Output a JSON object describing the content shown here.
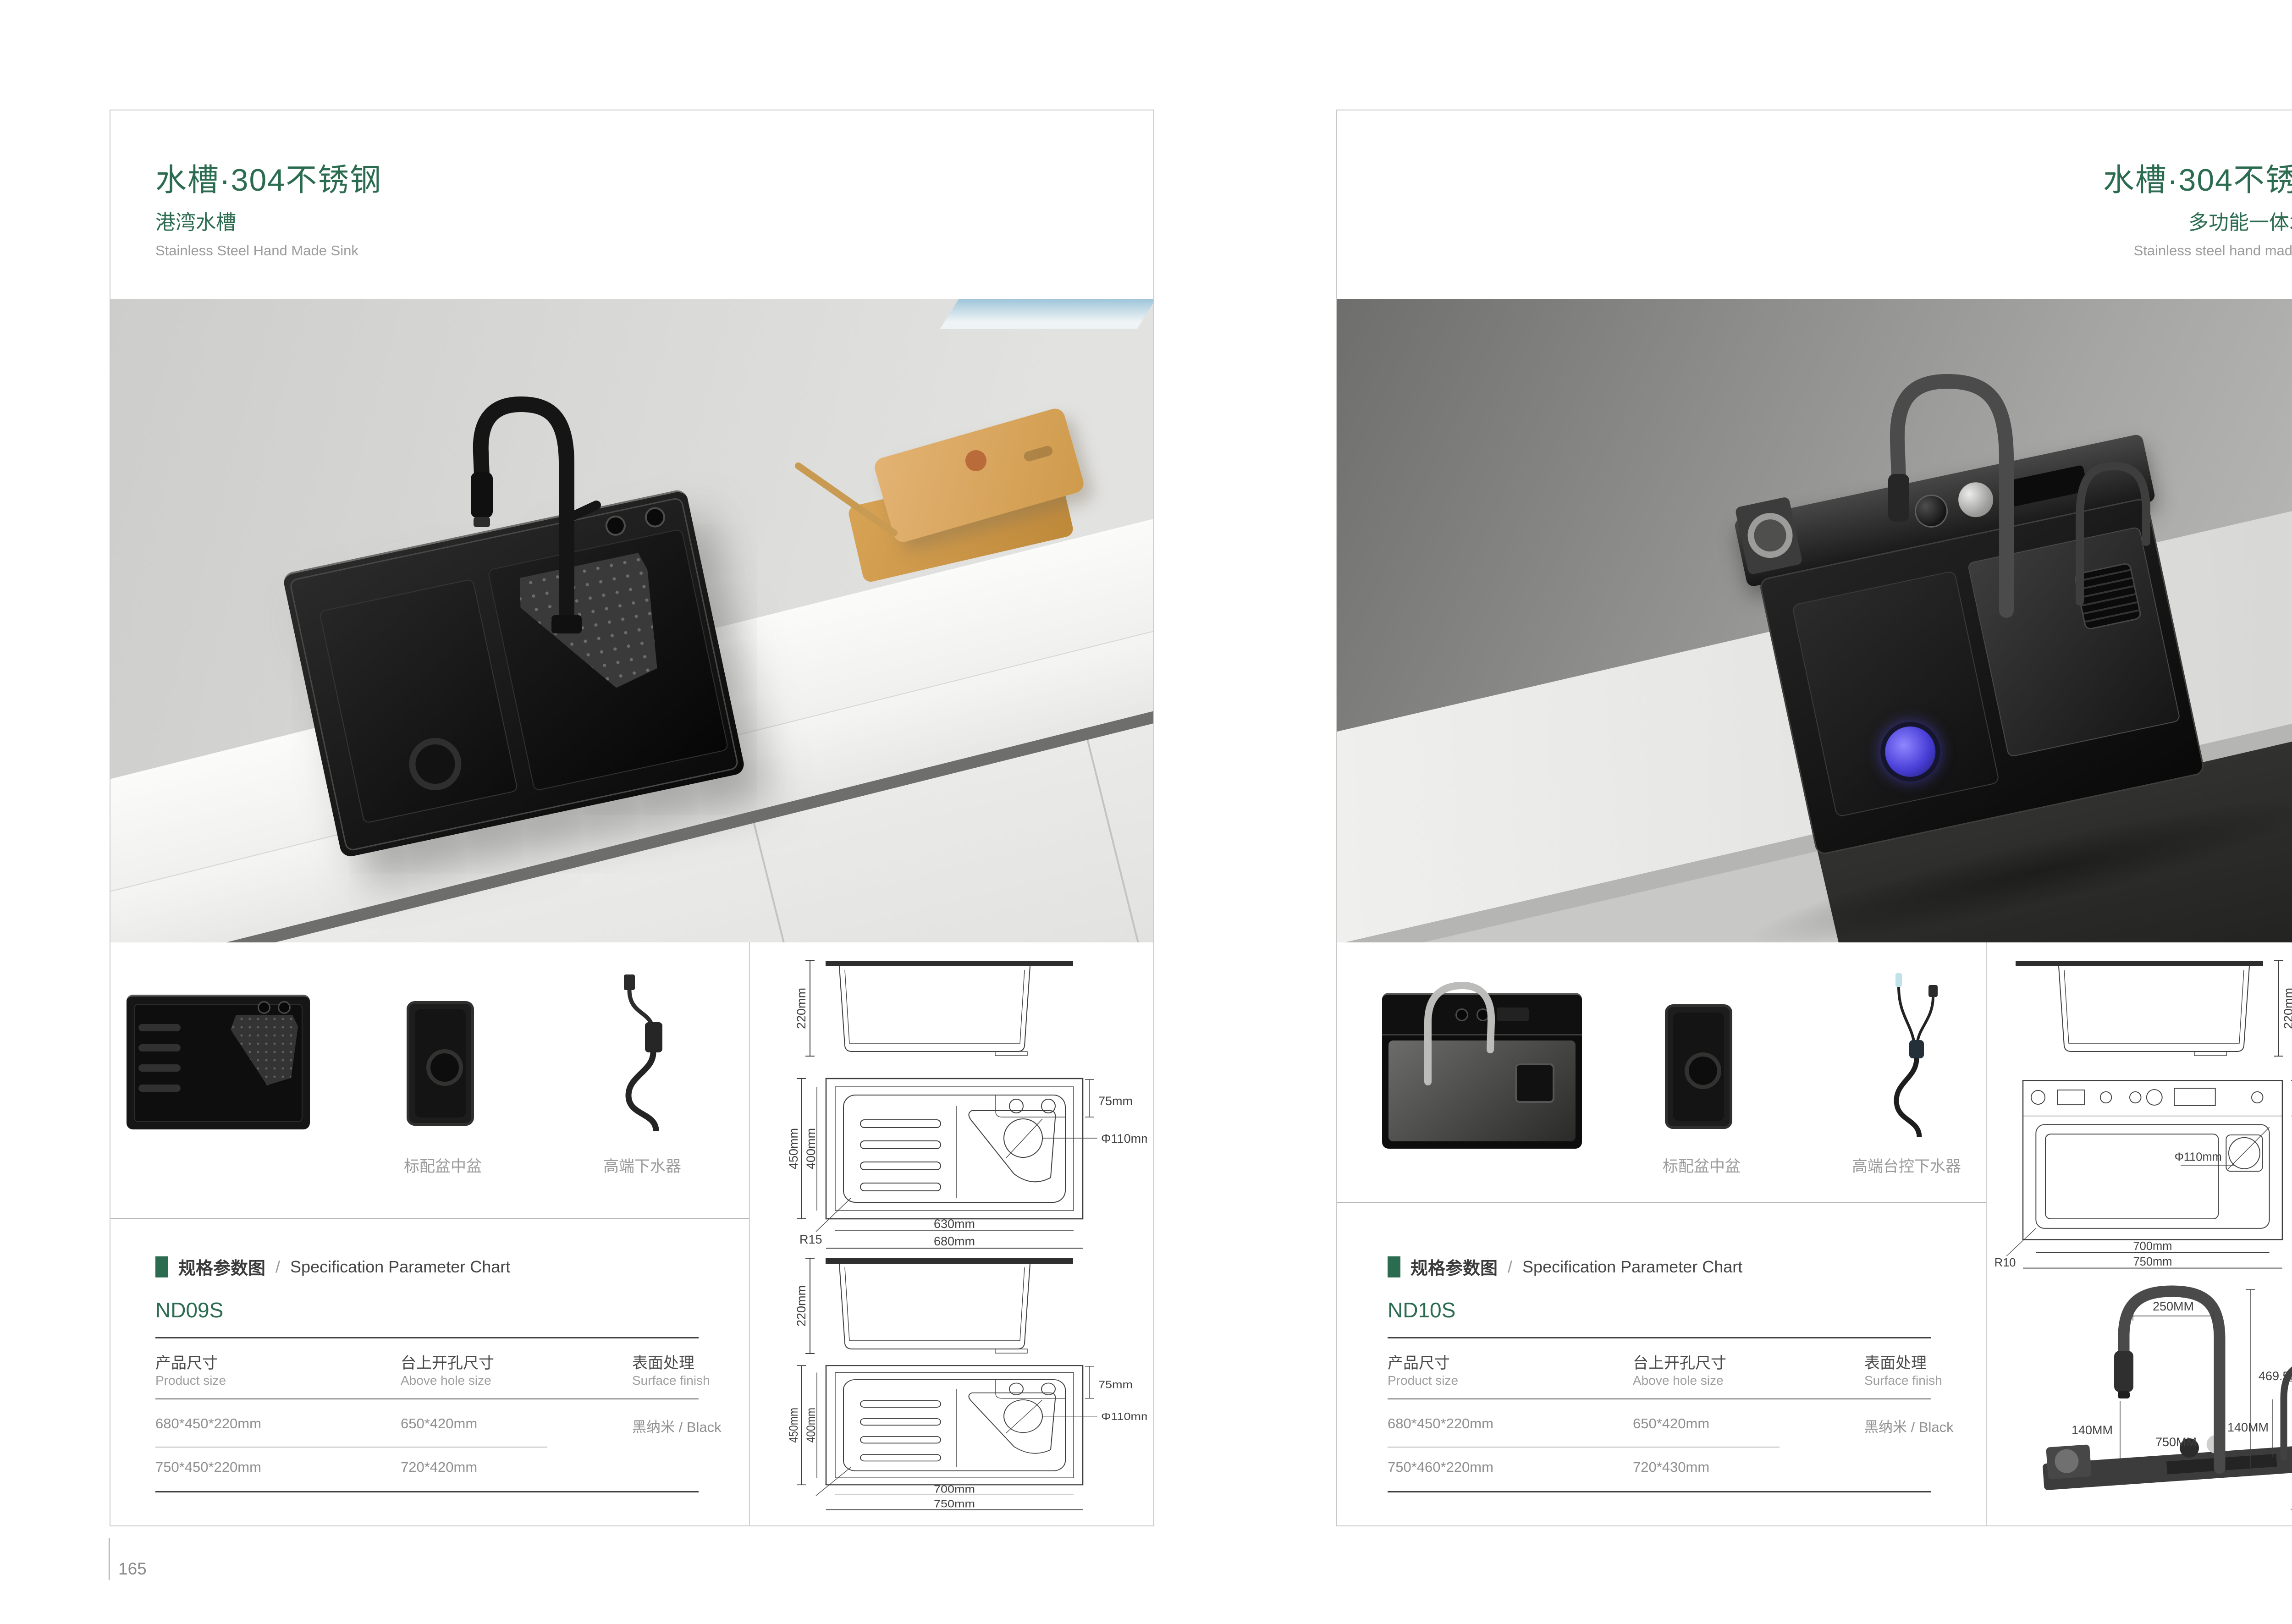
{
  "colors": {
    "accent_green": "#2b6b4f"
  },
  "left_page": {
    "page_number": "165",
    "title": "水槽·304不锈钢",
    "subtitle": "港湾水槽",
    "subtitle_en": "Stainless Steel Hand Made Sink",
    "thumb_label_mid": "标配盆中盆",
    "thumb_label_right": "高端下水器",
    "spec": {
      "section_cn": "规格参数图",
      "section_sep": "/",
      "section_en": "Specification Parameter Chart",
      "model": "ND09S",
      "col1_cn": "产品尺寸",
      "col1_en": "Product size",
      "col2_cn": "台上开孔尺寸",
      "col2_en": "Above hole size",
      "col3_cn": "表面处理",
      "col3_en": "Surface finish",
      "rows": [
        [
          "680*450*220mm",
          "650*420mm",
          "黑纳米 / Black"
        ],
        [
          "750*450*220mm",
          "720*420mm",
          ""
        ]
      ]
    },
    "drawings": {
      "side_height": "220mm",
      "plan1": {
        "outer_h": "450mm",
        "inner_h": "400mm",
        "ledge": "75mm",
        "dia": "Φ110mm",
        "radius": "R15",
        "inner_w": "630mm",
        "outer_w": "680mm"
      },
      "plan2": {
        "outer_h": "450mm",
        "inner_h": "400mm",
        "ledge": "75mm",
        "dia": "Φ110mm",
        "inner_w": "700mm",
        "outer_w": "750mm"
      }
    }
  },
  "right_page": {
    "page_number": "166",
    "title": "水槽·304不锈钢",
    "subtitle": "多功能一体水槽",
    "subtitle_en": "Stainless steel hand made sink",
    "thumb_label_mid": "标配盆中盆",
    "thumb_label_right": "高端台控下水器",
    "spec": {
      "section_cn": "规格参数图",
      "section_sep": "/",
      "section_en": "Specification Parameter Chart",
      "model": "ND10S",
      "col1_cn": "产品尺寸",
      "col1_en": "Product size",
      "col2_cn": "台上开孔尺寸",
      "col2_en": "Above hole size",
      "col3_cn": "表面处理",
      "col3_en": "Surface finish",
      "rows": [
        [
          "680*450*220mm",
          "650*420mm",
          "黑纳米 / Black"
        ],
        [
          "750*460*220mm",
          "720*430mm",
          ""
        ]
      ]
    },
    "drawings": {
      "side_height": "220mm",
      "plan": {
        "ledge": "80mm",
        "basin_h": "355mm",
        "outer_h": "460mm",
        "dia": "Φ110mm",
        "radius": "R10",
        "inner_w": "700mm",
        "outer_w": "750mm"
      },
      "faucet": {
        "spout_reach": "250MM",
        "total_height": "469.5MM",
        "spout_clearance": "140MM",
        "ledge_width": "750MM",
        "small_reach": "145MM",
        "small_clearance": "140MM",
        "small_height": "225MM",
        "ledge_thickness": "40MM",
        "ledge_depth": "80MM"
      }
    }
  }
}
